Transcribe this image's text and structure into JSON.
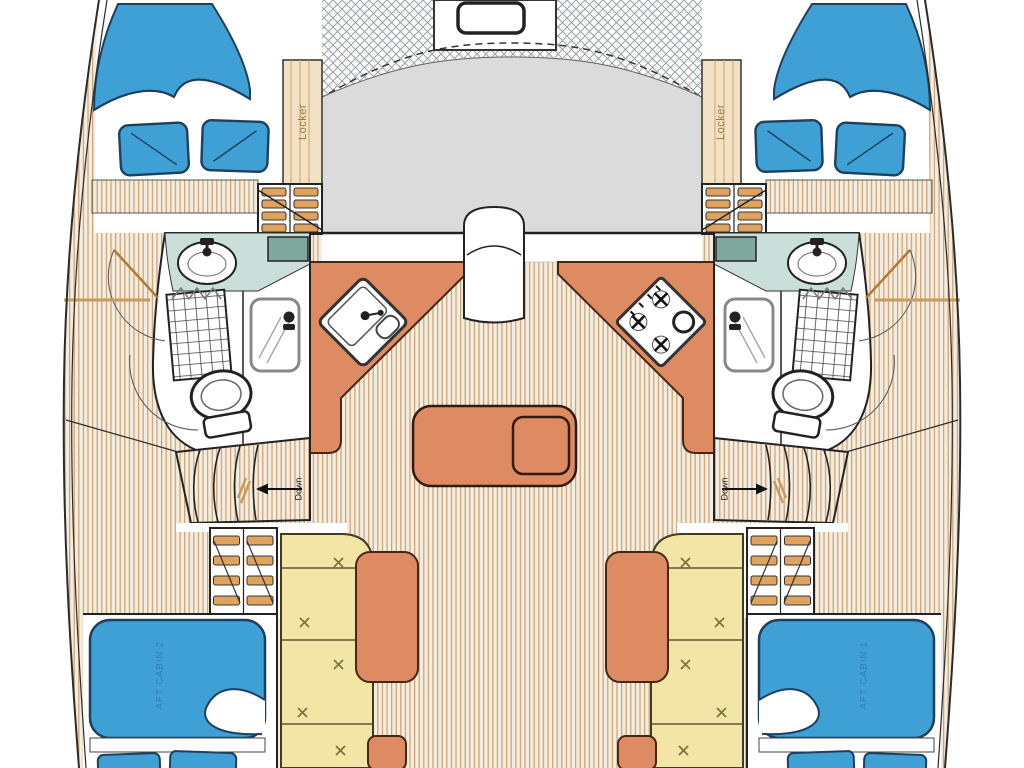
{
  "diagram": {
    "type": "boat-floor-plan",
    "subject": "catamaran-interior-layout-top-view",
    "labels": {
      "locker_port": "Locker",
      "locker_starboard": "Locker",
      "down_port": "Down",
      "down_starboard": "Down",
      "aft_cabin_port": "AFT CABIN 2",
      "aft_cabin_starboard": "AFT CABIN 1"
    },
    "theme": {
      "colors": {
        "bed_blue": "#3FA0D6",
        "bed_outline": "#1F3F5E",
        "cabin_text_blue": "#2B7CC0",
        "salmon": "#DE8A63",
        "salmon_outline": "#472712",
        "settee_yellow": "#F2E5A6",
        "settee_outline": "#3F3C20",
        "stitch_olive": "#7A6E3E",
        "floor_base": "#F4ECDC",
        "floor_line": "#C9A27A",
        "counter_teal": "#CBDFDA",
        "counter_teal_dark": "#7FA89F",
        "deck_gray": "#DBDBDB",
        "step_tan": "#E0A35E",
        "chevron_tan": "#C89A5E",
        "outline_dark": "#2B2B2B",
        "locker_bg": "#F2E2C3",
        "locker_text": "#9C7A3C",
        "net_line": "#9AA0A6",
        "door_wood": "#B07A3A"
      }
    },
    "components": [
      "hull-outline",
      "trampoline-net",
      "deck-hatch",
      "coachroof-deck",
      "forward-double-bed",
      "bed-pillows",
      "locker-cabinet",
      "companionway-steps",
      "bathroom",
      "bathroom-sink",
      "shower-tray",
      "shower-curtain",
      "shower-door",
      "toilet",
      "galley-counter",
      "galley-sink",
      "stove-4-burner",
      "entry-door",
      "saloon-table",
      "stairs-down",
      "cockpit-settee",
      "backrest-cushion",
      "aft-double-bed"
    ]
  }
}
